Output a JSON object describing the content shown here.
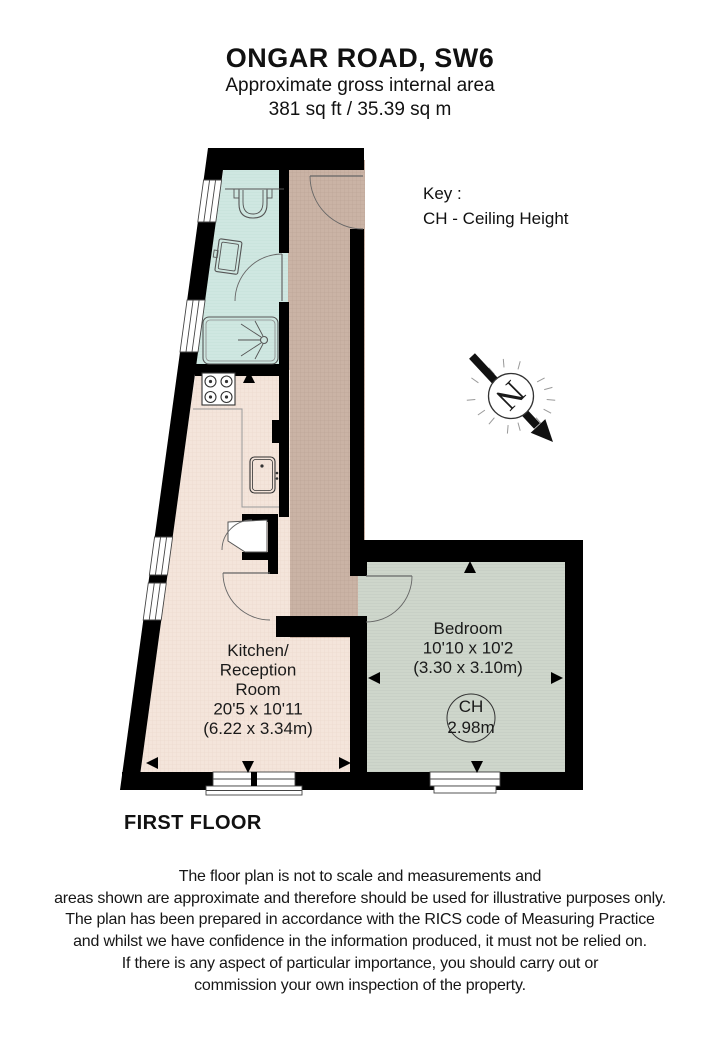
{
  "header": {
    "title": "ONGAR ROAD, SW6",
    "subtitle": "Approximate gross internal area",
    "area": "381 sq ft / 35.39 sq m"
  },
  "key": {
    "title": "Key :",
    "entry": "CH - Ceiling Height"
  },
  "compass": {
    "letter": "N"
  },
  "rooms": {
    "kitchen": {
      "line1": "Kitchen/",
      "line2": "Reception",
      "line3": "Room",
      "dims_imperial": "20'5 x 10'11",
      "dims_metric": "(6.22 x 3.34m)"
    },
    "bedroom": {
      "name": "Bedroom",
      "dims_imperial": "10'10 x 10'2",
      "dims_metric": "(3.30 x 3.10m)",
      "ch_label": "CH",
      "ch_value": "2.98m"
    }
  },
  "floor_label": "FIRST FLOOR",
  "disclaimer": {
    "line1": "The floor plan is not to scale and measurements and",
    "line2": "areas shown are approximate and therefore should be used for illustrative purposes only.",
    "line3": "The plan has been prepared in accordance with the RICS code of Measuring Practice",
    "line4": "and whilst we have confidence in the information produced, it must not be relied on.",
    "line5": "If there is any aspect of particular importance, you should carry out or",
    "line6": "commission your own inspection of the property."
  },
  "colors": {
    "bathroom": "#cfe7e1",
    "hallway": "#cab3a5",
    "kitchen": "#f4e5db",
    "bedroom": "#ced6cb",
    "wall": "#000000",
    "fixture_outline": "#555555"
  }
}
